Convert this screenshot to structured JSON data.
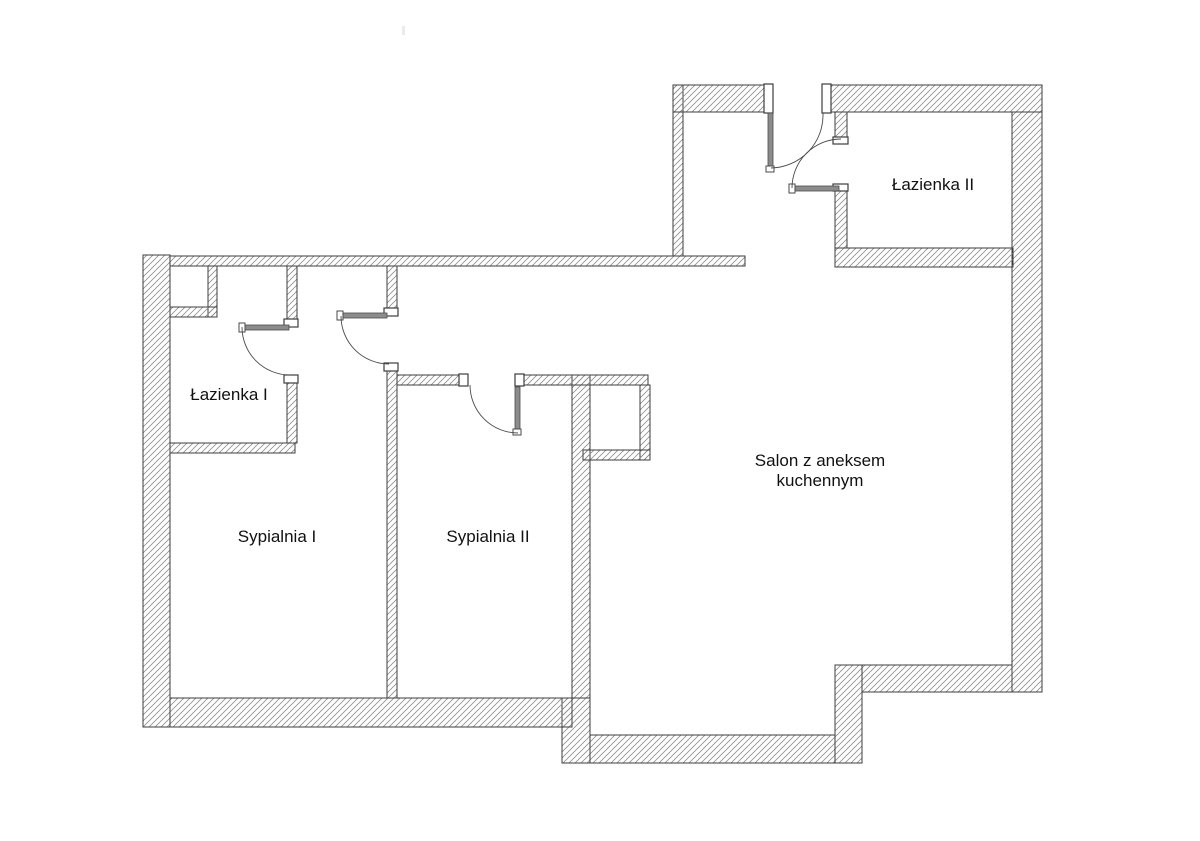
{
  "rooms": {
    "lazienka1": {
      "label": "Łazienka I"
    },
    "sypialnia1": {
      "label": "Sypialnia I"
    },
    "sypialnia2": {
      "label": "Sypialnia II"
    },
    "salon": {
      "label": "Salon z aneksem kuchennym",
      "label_line1": "Salon z aneksem",
      "label_line2": "kuchennym"
    },
    "lazienka2": {
      "label": "Łazienka II"
    }
  },
  "colors": {
    "background": "#ffffff",
    "wall_hatch": "#8f8f8f",
    "wall_outline": "#3d3d3d",
    "door_leaf": "#8c8c8c",
    "door_outline": "#4a4a4a",
    "text": "#111111"
  }
}
